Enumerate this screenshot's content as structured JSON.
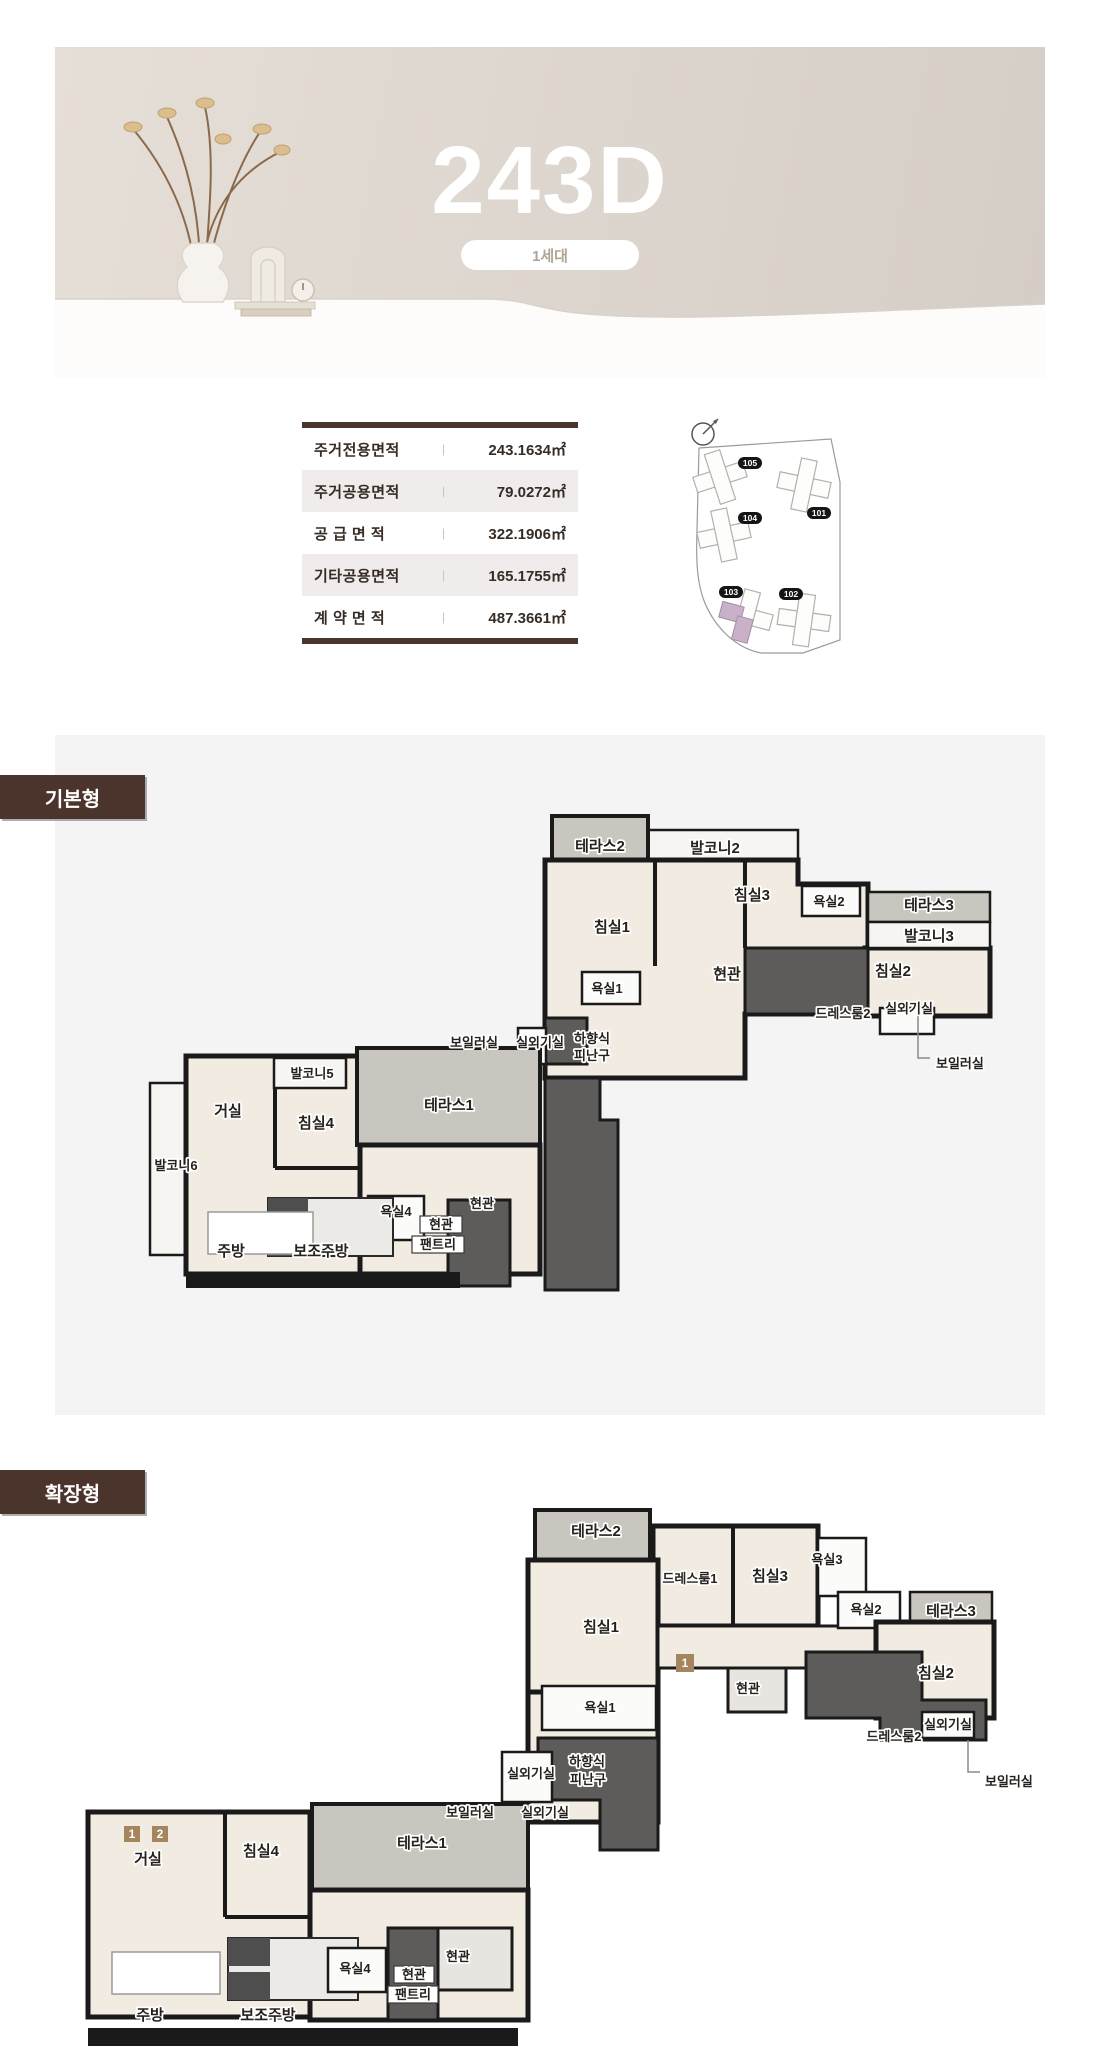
{
  "header": {
    "title": "243D",
    "badge": "1세대"
  },
  "area_table": {
    "separator": "|",
    "rows": [
      {
        "label": "주거전용면적",
        "value": "243.1634㎡"
      },
      {
        "label": "주거공용면적",
        "value": "79.0272㎡"
      },
      {
        "label": "공 급 면 적",
        "value": "322.1906㎡"
      },
      {
        "label": "기타공용면적",
        "value": "165.1755㎡"
      },
      {
        "label": "계 약 면 적",
        "value": "487.3661㎡"
      }
    ]
  },
  "site_plan": {
    "buildings": [
      "105",
      "101",
      "104",
      "103",
      "102"
    ],
    "highlight_building": "103",
    "highlight_color": "#c9b2c9"
  },
  "sections": {
    "basic": "기본형",
    "extended": "확장형"
  },
  "plan_basic": {
    "labels": [
      "테라스2",
      "발코니2",
      "침실3",
      "욕실2",
      "테라스3",
      "발코니3",
      "침실1",
      "욕실1",
      "현관",
      "침실2",
      "드레스룸2",
      "실외기실",
      "보일러실",
      "실외기실",
      "하향식",
      "피난구",
      "보일러실",
      "발코니5",
      "거실",
      "침실4",
      "테라스1",
      "발코니6",
      "욕실4",
      "현관",
      "현관",
      "팬트리",
      "주방",
      "보조주방"
    ]
  },
  "plan_extended": {
    "labels": [
      "테라스2",
      "드레스룸1",
      "침실3",
      "욕실3",
      "욕실2",
      "테라스3",
      "침실1",
      "현관",
      "침실2",
      "실외기실",
      "드레스룸2",
      "보일러실",
      "욕실1",
      "실외기실",
      "하향식",
      "피난구",
      "보일러실",
      "실외기실",
      "거실",
      "침실4",
      "테라스1",
      "주방",
      "보조주방",
      "욕실4",
      "현관",
      "현관",
      "팬트리"
    ],
    "unit_badges": [
      "1",
      "1",
      "2"
    ]
  },
  "colors": {
    "accent_brown": "#4a342b",
    "badge_brown": "#a5855e",
    "terrace_gray": "#c9c5bf"
  }
}
